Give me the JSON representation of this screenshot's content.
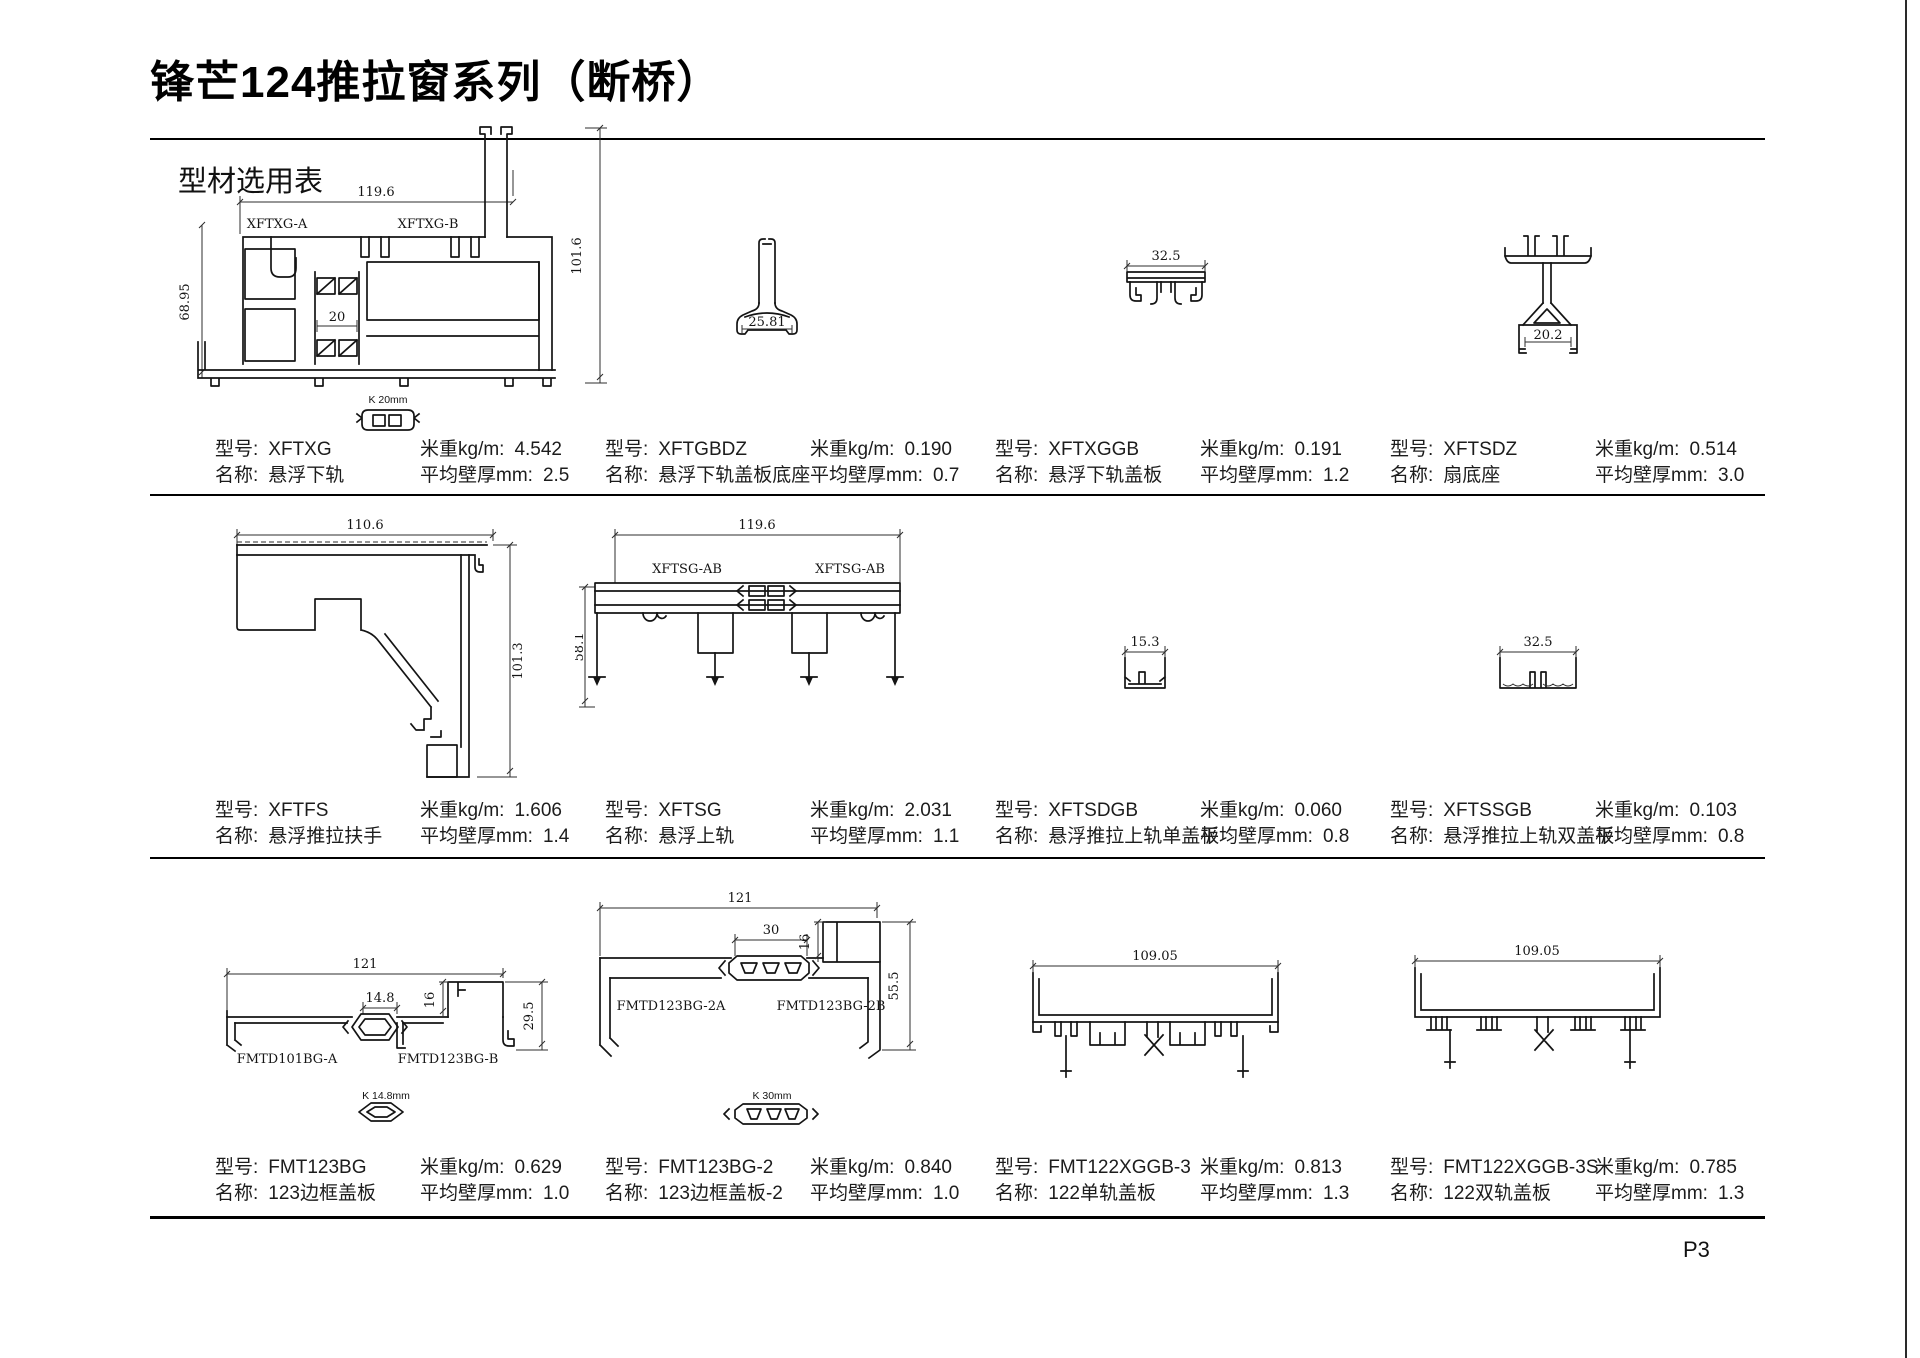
{
  "page": {
    "title": "锋芒124推拉窗系列（断桥）",
    "section_label": "型材选用表",
    "page_number": "P3"
  },
  "field_labels": {
    "model": "型号:",
    "name": "名称:",
    "weight": "米重kg/m:",
    "thickness": "平均壁厚mm:"
  },
  "colors": {
    "ink": "#141414",
    "background": "#ffffff"
  },
  "profiles": [
    {
      "model": "XFTXG",
      "name": "悬浮下轨",
      "weight": "4.542",
      "thickness": "2.5",
      "parts": [
        "XFTXG-A",
        "XFTXG-B"
      ],
      "insert_label": "K 20mm",
      "dims": {
        "width": "119.6",
        "left_height": "68.95",
        "total_height": "101.6",
        "break_width": "20"
      }
    },
    {
      "model": "XFTGBDZ",
      "name": "悬浮下轨盖板底座",
      "weight": "0.190",
      "thickness": "0.7",
      "dims": {
        "base_width": "25.81"
      }
    },
    {
      "model": "XFTXGGB",
      "name": "悬浮下轨盖板",
      "weight": "0.191",
      "thickness": "1.2",
      "dims": {
        "width": "32.5"
      }
    },
    {
      "model": "XFTSDZ",
      "name": "扇底座",
      "weight": "0.514",
      "thickness": "3.0",
      "dims": {
        "base_width": "20.2"
      }
    },
    {
      "model": "XFTFS",
      "name": "悬浮推拉扶手",
      "weight": "1.606",
      "thickness": "1.4",
      "dims": {
        "width": "110.6",
        "height": "101.3"
      }
    },
    {
      "model": "XFTSG",
      "name": "悬浮上轨",
      "weight": "2.031",
      "thickness": "1.1",
      "parts": [
        "XFTSG-AB",
        "XFTSG-AB"
      ],
      "dims": {
        "width": "119.6",
        "height": "58.1"
      }
    },
    {
      "model": "XFTSDGB",
      "name": "悬浮推拉上轨单盖板",
      "weight": "0.060",
      "thickness": "0.8",
      "dims": {
        "width": "15.3"
      }
    },
    {
      "model": "XFTSSGB",
      "name": "悬浮推拉上轨双盖板",
      "weight": "0.103",
      "thickness": "0.8",
      "dims": {
        "width": "32.5"
      }
    },
    {
      "model": "FMT123BG",
      "name": "123边框盖板",
      "weight": "0.629",
      "thickness": "1.0",
      "parts": [
        "FMTD101BG-A",
        "FMTD123BG-B"
      ],
      "insert_label": "K 14.8mm",
      "dims": {
        "width": "121",
        "insert_width": "14.8",
        "step_height": "16",
        "end_height": "29.5"
      }
    },
    {
      "model": "FMT123BG-2",
      "name": "123边框盖板-2",
      "weight": "0.840",
      "thickness": "1.0",
      "parts": [
        "FMTD123BG-2A",
        "FMTD123BG-2B"
      ],
      "insert_label": "K 30mm",
      "dims": {
        "width": "121",
        "insert_width": "30",
        "step_height": "16",
        "end_height": "55.5"
      }
    },
    {
      "model": "FMT122XGGB-3",
      "name": "122单轨盖板",
      "weight": "0.813",
      "thickness": "1.3",
      "dims": {
        "width": "109.05"
      }
    },
    {
      "model": "FMT122XGGB-3S",
      "name": "122双轨盖板",
      "weight": "0.785",
      "thickness": "1.3",
      "dims": {
        "width": "109.05"
      }
    }
  ]
}
